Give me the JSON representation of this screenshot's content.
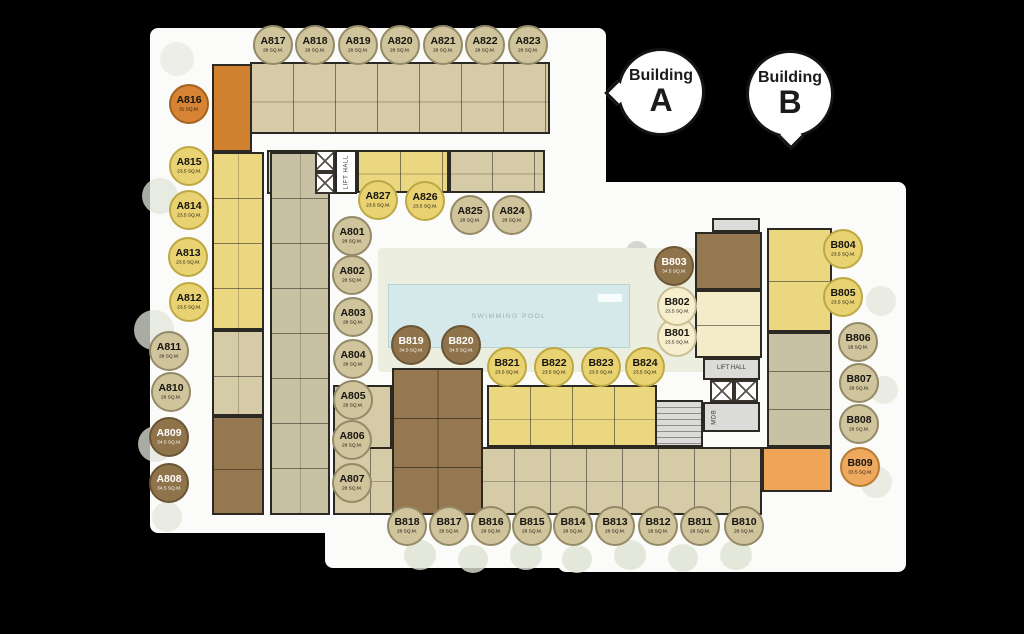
{
  "bubbles": {
    "a": {
      "word": "Building",
      "letter": "A"
    },
    "b": {
      "word": "Building",
      "letter": "B"
    }
  },
  "plan_labels": {
    "swimming_pool": "SWIMMING POOL",
    "lift_hall_a": "LIFT HALL",
    "mdb_a": "MDB",
    "lift_hall_b": "LIFT HALL",
    "mdb_b": "MDB"
  },
  "legend_colors": {
    "tan_28sqm": "#cfc49c",
    "yellow_23_5sqm": "#e8d272",
    "cream_23_5sqm": "#f7eecd",
    "brown_34_5sqm": "#8f734b",
    "orange_31sqm": "#d68434",
    "orange_33_5sqm": "#efa95e"
  },
  "units": [
    {
      "id": "A801",
      "size": "28 SQ.M.",
      "type": "tan",
      "x": 352,
      "y": 236
    },
    {
      "id": "A802",
      "size": "28 SQ.M.",
      "type": "tan",
      "x": 352,
      "y": 275
    },
    {
      "id": "A803",
      "size": "28 SQ.M.",
      "type": "tan",
      "x": 353,
      "y": 317
    },
    {
      "id": "A804",
      "size": "28 SQ.M.",
      "type": "tan",
      "x": 353,
      "y": 359
    },
    {
      "id": "A805",
      "size": "28 SQ.M.",
      "type": "tan",
      "x": 353,
      "y": 400
    },
    {
      "id": "A806",
      "size": "28 SQ.M.",
      "type": "tan",
      "x": 352,
      "y": 440
    },
    {
      "id": "A807",
      "size": "28 SQ.M.",
      "type": "tan",
      "x": 352,
      "y": 483
    },
    {
      "id": "A808",
      "size": "34.5 SQ.M.",
      "type": "brown",
      "x": 169,
      "y": 483
    },
    {
      "id": "A809",
      "size": "34.5 SQ.M.",
      "type": "brown",
      "x": 169,
      "y": 437
    },
    {
      "id": "A810",
      "size": "28 SQ.M.",
      "type": "tan",
      "x": 171,
      "y": 392
    },
    {
      "id": "A811",
      "size": "28 SQ.M.",
      "type": "tan",
      "x": 169,
      "y": 351
    },
    {
      "id": "A812",
      "size": "23.5 SQ.M.",
      "type": "yellow",
      "x": 189,
      "y": 302
    },
    {
      "id": "A813",
      "size": "23.5 SQ.M.",
      "type": "yellow",
      "x": 188,
      "y": 257
    },
    {
      "id": "A814",
      "size": "23.5 SQ.M.",
      "type": "yellow",
      "x": 189,
      "y": 210
    },
    {
      "id": "A815",
      "size": "23.5 SQ.M.",
      "type": "yellow",
      "x": 189,
      "y": 166
    },
    {
      "id": "A816",
      "size": "31 SQ.M.",
      "type": "orange",
      "x": 189,
      "y": 104
    },
    {
      "id": "A817",
      "size": "28 SQ.M.",
      "type": "tan",
      "x": 273,
      "y": 45
    },
    {
      "id": "A818",
      "size": "28 SQ.M.",
      "type": "tan",
      "x": 315,
      "y": 45
    },
    {
      "id": "A819",
      "size": "28 SQ.M.",
      "type": "tan",
      "x": 358,
      "y": 45
    },
    {
      "id": "A820",
      "size": "28 SQ.M.",
      "type": "tan",
      "x": 400,
      "y": 45
    },
    {
      "id": "A821",
      "size": "28 SQ.M.",
      "type": "tan",
      "x": 443,
      "y": 45
    },
    {
      "id": "A822",
      "size": "28 SQ.M.",
      "type": "tan",
      "x": 485,
      "y": 45
    },
    {
      "id": "A823",
      "size": "28 SQ.M.",
      "type": "tan",
      "x": 528,
      "y": 45
    },
    {
      "id": "A824",
      "size": "28 SQ.M.",
      "type": "tan",
      "x": 512,
      "y": 215
    },
    {
      "id": "A825",
      "size": "28 SQ.M.",
      "type": "tan",
      "x": 470,
      "y": 215
    },
    {
      "id": "A826",
      "size": "23.5 SQ.M.",
      "type": "yellow",
      "x": 425,
      "y": 201
    },
    {
      "id": "A827",
      "size": "23.5 SQ.M.",
      "type": "yellow",
      "x": 378,
      "y": 200
    },
    {
      "id": "B801",
      "size": "23.5 SQ.M.",
      "type": "cream",
      "x": 677,
      "y": 337
    },
    {
      "id": "B802",
      "size": "23.5 SQ.M.",
      "type": "cream",
      "x": 677,
      "y": 306
    },
    {
      "id": "B803",
      "size": "34.5 SQ.M.",
      "type": "brown",
      "x": 674,
      "y": 266
    },
    {
      "id": "B804",
      "size": "23.5 SQ.M.",
      "type": "yellow",
      "x": 843,
      "y": 249
    },
    {
      "id": "B805",
      "size": "23.5 SQ.M.",
      "type": "yellow",
      "x": 843,
      "y": 297
    },
    {
      "id": "B806",
      "size": "28 SQ.M.",
      "type": "tan",
      "x": 858,
      "y": 342
    },
    {
      "id": "B807",
      "size": "28 SQ.M.",
      "type": "tan",
      "x": 859,
      "y": 383
    },
    {
      "id": "B808",
      "size": "28 SQ.M.",
      "type": "tan",
      "x": 859,
      "y": 424
    },
    {
      "id": "B809",
      "size": "33.5 SQ.M.",
      "type": "orange_light",
      "x": 860,
      "y": 467
    },
    {
      "id": "B810",
      "size": "28 SQ.M.",
      "type": "tan",
      "x": 744,
      "y": 526
    },
    {
      "id": "B811",
      "size": "28 SQ.M.",
      "type": "tan",
      "x": 700,
      "y": 526
    },
    {
      "id": "B812",
      "size": "28 SQ.M.",
      "type": "tan",
      "x": 658,
      "y": 526
    },
    {
      "id": "B813",
      "size": "28 SQ.M.",
      "type": "tan",
      "x": 615,
      "y": 526
    },
    {
      "id": "B814",
      "size": "28 SQ.M.",
      "type": "tan",
      "x": 573,
      "y": 526
    },
    {
      "id": "B815",
      "size": "28 SQ.M.",
      "type": "tan",
      "x": 532,
      "y": 526
    },
    {
      "id": "B816",
      "size": "28 SQ.M.",
      "type": "tan",
      "x": 491,
      "y": 526
    },
    {
      "id": "B817",
      "size": "28 SQ.M.",
      "type": "tan",
      "x": 449,
      "y": 526
    },
    {
      "id": "B818",
      "size": "28 SQ.M.",
      "type": "tan",
      "x": 407,
      "y": 526
    },
    {
      "id": "B819",
      "size": "34.5 SQ.M.",
      "type": "brown",
      "x": 411,
      "y": 345
    },
    {
      "id": "B820",
      "size": "34.5 SQ.M.",
      "type": "brown",
      "x": 461,
      "y": 345
    },
    {
      "id": "B821",
      "size": "23.5 SQ.M.",
      "type": "yellow",
      "x": 507,
      "y": 367
    },
    {
      "id": "B822",
      "size": "23.5 SQ.M.",
      "type": "yellow",
      "x": 554,
      "y": 367
    },
    {
      "id": "B823",
      "size": "23.5 SQ.M.",
      "type": "yellow",
      "x": 601,
      "y": 367
    },
    {
      "id": "B824",
      "size": "23.5 SQ.M.",
      "type": "yellow",
      "x": 645,
      "y": 367
    }
  ]
}
